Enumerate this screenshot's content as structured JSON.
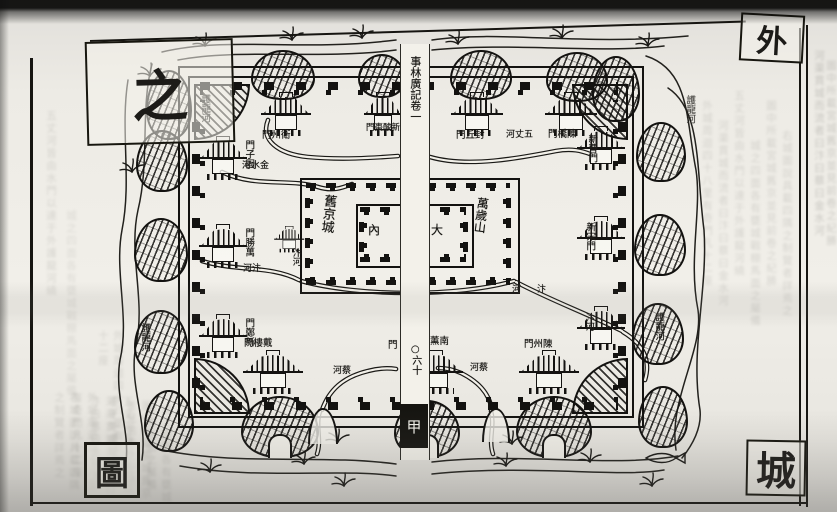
{
  "title_plate": {
    "top_left": "之",
    "top_right": "外",
    "bottom_left": "圖",
    "bottom_right": "城"
  },
  "spine": {
    "book_title": "事林廣記卷一",
    "folio": "○六十",
    "section": "甲"
  },
  "inner_city": {
    "name": "舊京城",
    "palace_inner": "內",
    "palace_outer": "大",
    "hill": "萬歲山"
  },
  "gates": {
    "north": [
      "門州衛",
      "門棗酸新",
      "門丘封",
      "門橋陳"
    ],
    "west": [
      "門子固",
      "門勝萬",
      "門鄭新"
    ],
    "east": [
      "新曹門",
      "新宋門"
    ],
    "south": {
      "left": "門樓戴",
      "center_left": "門",
      "center_right": "薰南",
      "right": "門州陳"
    }
  },
  "rivers": {
    "moat_nw": "護龍河",
    "moat_sw": "護龍河",
    "moat_ne": "護龍河",
    "moat_se": "護龍河",
    "jinshui": "河水金",
    "wuzhang": "河丈五",
    "bian_entry": "河汴",
    "bian_inner": "汴河",
    "bian_exit": "河汴",
    "bian_exit_v": "汴河",
    "cai_left": "河蔡",
    "cai_right": "河蔡"
  },
  "ink_color": "#161511",
  "paper_color": "#f1efe9",
  "bleed_text": [
    "外城周迴四十八里有奇門凡十二座",
    "河渠貫城而流者曰汴曰蔡曰金水河",
    "五丈河皆由水門以達于外護龍河繞",
    "城之四面各有甕城戰棚馬面之屬備",
    "圖中所載宮城舊京並見前卷之紀勝",
    "右城圖說具載四隅之制覽者詳焉之"
  ]
}
